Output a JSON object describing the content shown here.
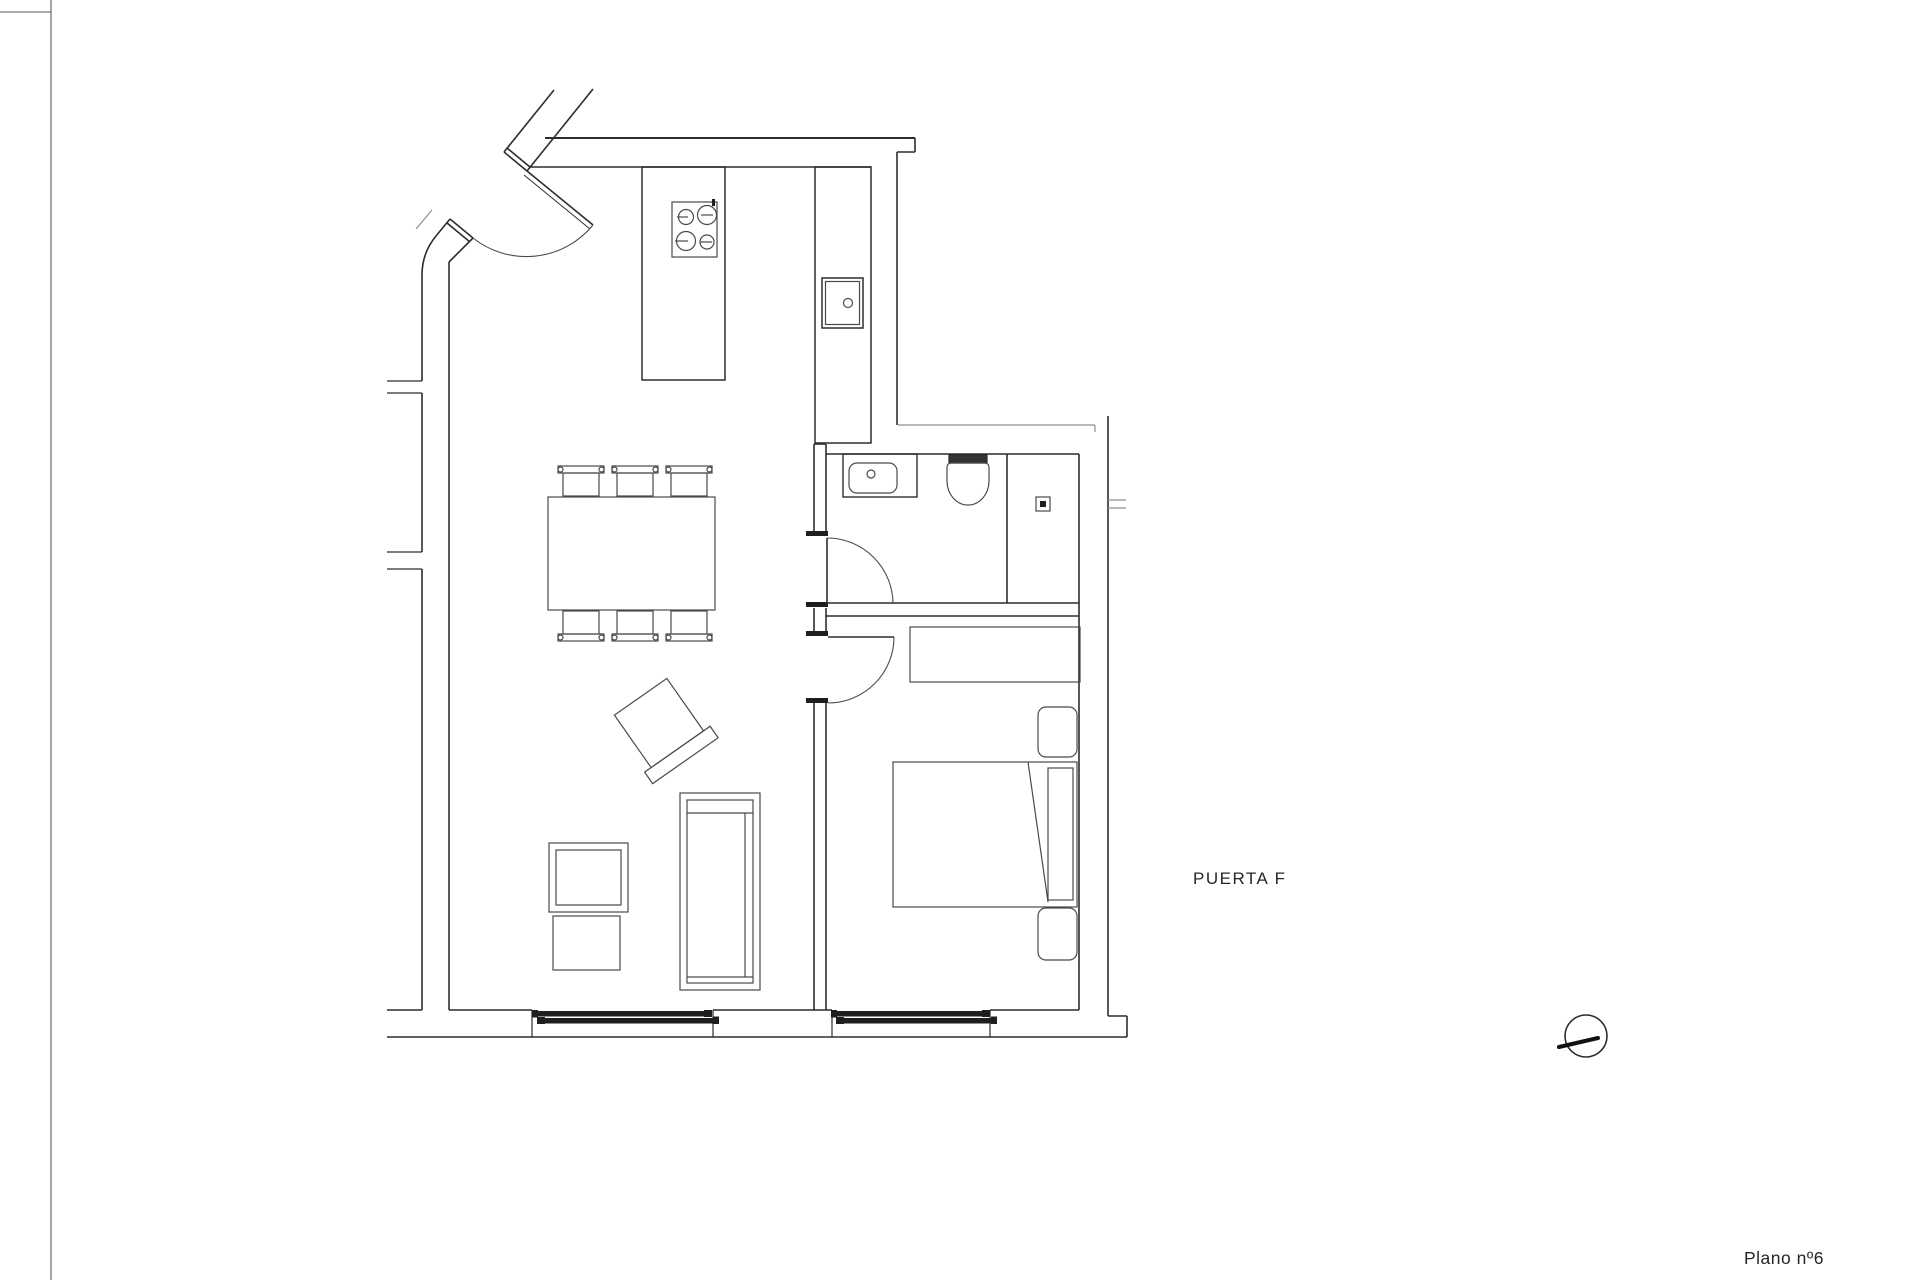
{
  "sheet": {
    "background": "#ffffff",
    "line_color": "#2d2d2d",
    "secondary_line_color": "#8f8f8f",
    "window_fill_color": "#1f1f1f"
  },
  "labels": {
    "door": "PUERTA F",
    "plan_number": "Plano nº6"
  }
}
